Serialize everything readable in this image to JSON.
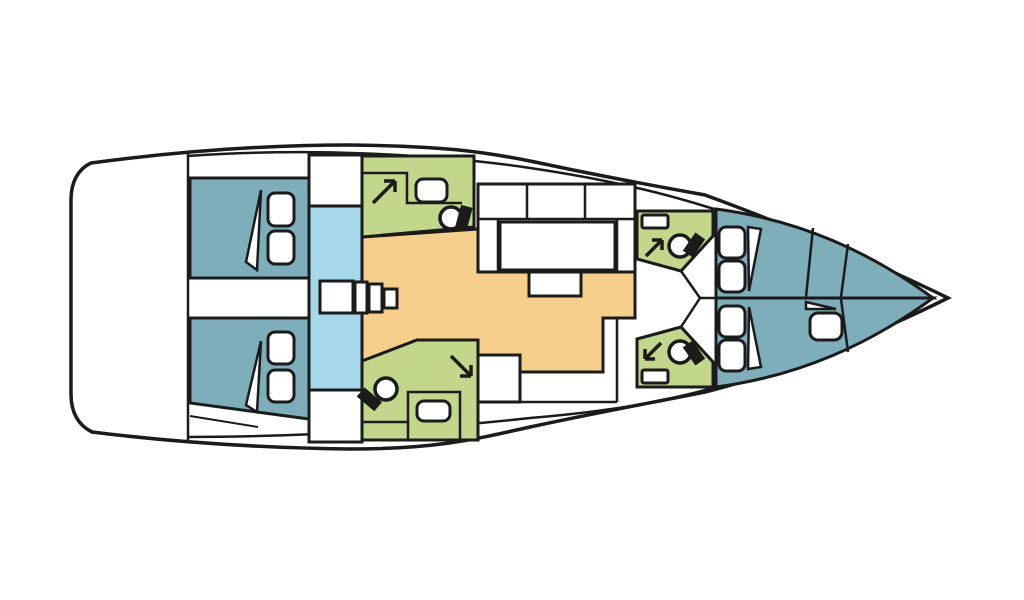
{
  "diagram": {
    "title": "sailing-yacht-interior-layout",
    "type": "boat floor plan, top view",
    "orientation": "bow pointing right, stern at left"
  },
  "colors": {
    "background": "#ffffff",
    "outline": "#1b1b1b",
    "hull_fill": "#ffffff",
    "cabin_blue": "#7faebb",
    "corridor_light_blue": "#a7d8ea",
    "wet_room_green": "#c2d78c",
    "salon_orange": "#f6cf8d",
    "fixture_white": "#ffffff"
  },
  "rooms": [
    {
      "id": "aft-cabin-port",
      "label": "aft double cabin (port quarter)",
      "color_ref": "cabin_blue",
      "fixtures": [
        "double berth",
        "2 pillows",
        "folded sheet"
      ]
    },
    {
      "id": "aft-cabin-starboard",
      "label": "aft double cabin (starboard quarter)",
      "color_ref": "cabin_blue",
      "fixtures": [
        "double berth",
        "2 pillows",
        "folded sheet"
      ]
    },
    {
      "id": "companionway",
      "label": "companionway corridor with steps",
      "color_ref": "corridor_light_blue",
      "fixtures": [
        "4 steps"
      ]
    },
    {
      "id": "aft-head-port",
      "label": "aft head / bathroom (port)",
      "color_ref": "wet_room_green",
      "fixtures": [
        "shower arrow",
        "sink",
        "toilet"
      ]
    },
    {
      "id": "aft-head-starboard",
      "label": "aft head / bathroom (starboard)",
      "color_ref": "wet_room_green",
      "fixtures": [
        "shower arrow",
        "sink",
        "toilet"
      ]
    },
    {
      "id": "salon",
      "label": "salon and galley area",
      "color_ref": "salon_orange",
      "fixtures": [
        "dinette table",
        "bench seats",
        "chart table"
      ]
    },
    {
      "id": "fwd-head-port",
      "label": "forward head (port)",
      "color_ref": "wet_room_green",
      "fixtures": [
        "shower arrow",
        "sink",
        "toilet"
      ]
    },
    {
      "id": "fwd-head-starboard",
      "label": "forward head (starboard)",
      "color_ref": "wet_room_green",
      "fixtures": [
        "shower arrow",
        "sink",
        "toilet"
      ]
    },
    {
      "id": "fwd-cabin-port",
      "label": "forward V-berth cabin (port)",
      "color_ref": "cabin_blue",
      "fixtures": [
        "berth",
        "2 pillows",
        "folded sheet"
      ]
    },
    {
      "id": "fwd-cabin-starboard",
      "label": "forward V-berth cabin (starboard)",
      "color_ref": "cabin_blue",
      "fixtures": [
        "berth",
        "3 pillows",
        "folded sheet"
      ]
    }
  ]
}
